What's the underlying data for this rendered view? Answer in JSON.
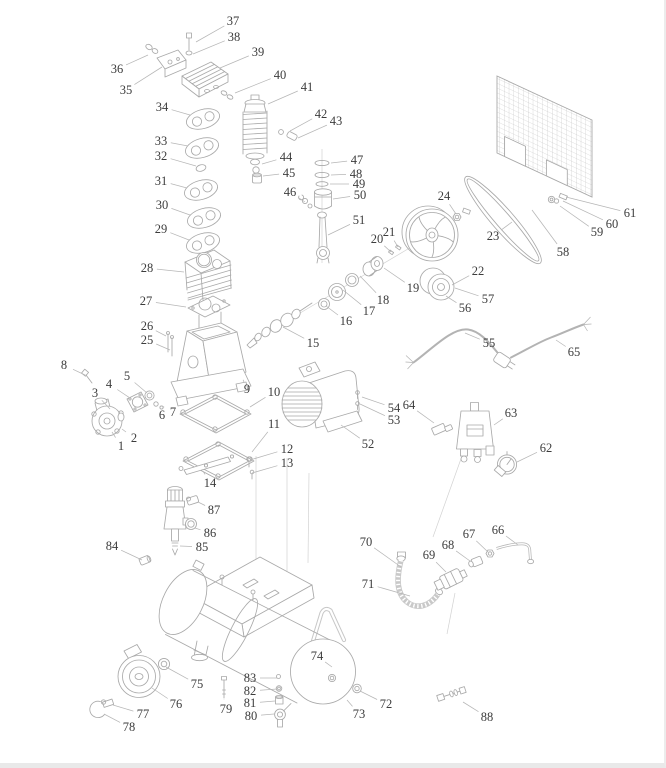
{
  "diagram": {
    "type": "exploded-parts-diagram",
    "colors": {
      "label_ink": "#3c3c3c",
      "leader_line": "#b6b6b6",
      "art_line": "#a9a9a9",
      "background": "#ffffff"
    },
    "parts": [
      {
        "n": "1",
        "x": 121,
        "y": 446,
        "tx": 112,
        "ty": 432
      },
      {
        "n": "2",
        "x": 134,
        "y": 438,
        "tx": 122,
        "ty": 429
      },
      {
        "n": "3",
        "x": 95,
        "y": 393,
        "tx": 110,
        "ty": 409
      },
      {
        "n": "4",
        "x": 109,
        "y": 384,
        "tx": 130,
        "ty": 398
      },
      {
        "n": "5",
        "x": 127,
        "y": 376,
        "tx": 147,
        "ty": 393
      },
      {
        "n": "6",
        "x": 162,
        "y": 415,
        "tx": 156,
        "ty": 407
      },
      {
        "n": "7",
        "x": 173,
        "y": 412,
        "tx": 162,
        "ty": 406
      },
      {
        "n": "8",
        "x": 64,
        "y": 365,
        "tx": 85,
        "ty": 375
      },
      {
        "n": "9",
        "x": 247,
        "y": 389,
        "tx": 244,
        "ty": 382,
        "s": 10
      },
      {
        "n": "10",
        "x": 274,
        "y": 392,
        "tx": 250,
        "ty": 407
      },
      {
        "n": "11",
        "x": 274,
        "y": 424,
        "tx": 252,
        "ty": 452
      },
      {
        "n": "12",
        "x": 287,
        "y": 449,
        "tx": 250,
        "ty": 460
      },
      {
        "n": "13",
        "x": 287,
        "y": 463,
        "tx": 252,
        "ty": 473
      },
      {
        "n": "14",
        "x": 210,
        "y": 483,
        "tx": 203,
        "ty": 471
      },
      {
        "n": "15",
        "x": 313,
        "y": 343,
        "tx": 283,
        "ty": 327
      },
      {
        "n": "16",
        "x": 346,
        "y": 321,
        "tx": 326,
        "ty": 306
      },
      {
        "n": "17",
        "x": 369,
        "y": 311,
        "tx": 343,
        "ty": 290
      },
      {
        "n": "18",
        "x": 383,
        "y": 300,
        "tx": 360,
        "ty": 276
      },
      {
        "n": "19",
        "x": 413,
        "y": 288,
        "tx": 384,
        "ty": 268
      },
      {
        "n": "20",
        "x": 377,
        "y": 239,
        "tx": 391,
        "ty": 252
      },
      {
        "n": "21",
        "x": 389,
        "y": 232,
        "tx": 398,
        "ty": 247
      },
      {
        "n": "22",
        "x": 478,
        "y": 271,
        "tx": 452,
        "ty": 285
      },
      {
        "n": "23",
        "x": 493,
        "y": 236,
        "tx": 512,
        "ty": 222
      },
      {
        "n": "24",
        "x": 444,
        "y": 196,
        "tx": 456,
        "ty": 214
      },
      {
        "n": "25",
        "x": 147,
        "y": 340,
        "tx": 170,
        "ty": 350
      },
      {
        "n": "26",
        "x": 147,
        "y": 326,
        "tx": 166,
        "ty": 336
      },
      {
        "n": "27",
        "x": 146,
        "y": 301,
        "tx": 186,
        "ty": 307
      },
      {
        "n": "28",
        "x": 147,
        "y": 268,
        "tx": 184,
        "ty": 272
      },
      {
        "n": "29",
        "x": 161,
        "y": 229,
        "tx": 189,
        "ty": 240
      },
      {
        "n": "30",
        "x": 162,
        "y": 205,
        "tx": 190,
        "ty": 215
      },
      {
        "n": "31",
        "x": 161,
        "y": 181,
        "tx": 187,
        "ty": 188
      },
      {
        "n": "32",
        "x": 161,
        "y": 156,
        "tx": 196,
        "ty": 166
      },
      {
        "n": "33",
        "x": 161,
        "y": 141,
        "tx": 188,
        "ty": 146
      },
      {
        "n": "34",
        "x": 162,
        "y": 107,
        "tx": 190,
        "ty": 115
      },
      {
        "n": "35",
        "x": 126,
        "y": 90,
        "tx": 162,
        "ty": 67
      },
      {
        "n": "36",
        "x": 117,
        "y": 69,
        "tx": 148,
        "ty": 55
      },
      {
        "n": "37",
        "x": 233,
        "y": 21,
        "tx": 196,
        "ty": 42
      },
      {
        "n": "38",
        "x": 234,
        "y": 37,
        "tx": 193,
        "ty": 54
      },
      {
        "n": "39",
        "x": 258,
        "y": 52,
        "tx": 220,
        "ty": 68
      },
      {
        "n": "40",
        "x": 280,
        "y": 75,
        "tx": 235,
        "ty": 93
      },
      {
        "n": "41",
        "x": 307,
        "y": 87,
        "tx": 268,
        "ty": 104
      },
      {
        "n": "42",
        "x": 321,
        "y": 114,
        "tx": 290,
        "ty": 131
      },
      {
        "n": "43",
        "x": 336,
        "y": 121,
        "tx": 298,
        "ty": 138
      },
      {
        "n": "44",
        "x": 286,
        "y": 157,
        "tx": 262,
        "ty": 164
      },
      {
        "n": "45",
        "x": 289,
        "y": 173,
        "tx": 263,
        "ty": 176
      },
      {
        "n": "46",
        "x": 290,
        "y": 192,
        "tx": 305,
        "ty": 202
      },
      {
        "n": "47",
        "x": 357,
        "y": 160,
        "tx": 331,
        "ty": 163
      },
      {
        "n": "48",
        "x": 356,
        "y": 174,
        "tx": 331,
        "ty": 175
      },
      {
        "n": "49",
        "x": 359,
        "y": 184,
        "tx": 330,
        "ty": 184
      },
      {
        "n": "50",
        "x": 360,
        "y": 195,
        "tx": 333,
        "ty": 199
      },
      {
        "n": "51",
        "x": 359,
        "y": 220,
        "tx": 328,
        "ty": 235
      },
      {
        "n": "52",
        "x": 368,
        "y": 444,
        "tx": 341,
        "ty": 425
      },
      {
        "n": "53",
        "x": 394,
        "y": 420,
        "tx": 360,
        "ty": 404
      },
      {
        "n": "54",
        "x": 394,
        "y": 408,
        "tx": 362,
        "ty": 397
      },
      {
        "n": "55",
        "x": 489,
        "y": 343,
        "tx": 465,
        "ty": 333
      },
      {
        "n": "56",
        "x": 465,
        "y": 308,
        "tx": 446,
        "ty": 296
      },
      {
        "n": "57",
        "x": 488,
        "y": 299,
        "tx": 455,
        "ty": 288
      },
      {
        "n": "58",
        "x": 563,
        "y": 252,
        "tx": 532,
        "ty": 210
      },
      {
        "n": "59",
        "x": 597,
        "y": 232,
        "tx": 560,
        "ty": 206
      },
      {
        "n": "60",
        "x": 612,
        "y": 224,
        "tx": 563,
        "ty": 201
      },
      {
        "n": "61",
        "x": 630,
        "y": 213,
        "tx": 566,
        "ty": 197
      },
      {
        "n": "62",
        "x": 546,
        "y": 448,
        "tx": 517,
        "ty": 462
      },
      {
        "n": "63",
        "x": 511,
        "y": 413,
        "tx": 494,
        "ty": 425
      },
      {
        "n": "64",
        "x": 409,
        "y": 405,
        "tx": 434,
        "ty": 423
      },
      {
        "n": "65",
        "x": 574,
        "y": 352,
        "tx": 556,
        "ty": 340
      },
      {
        "n": "66",
        "x": 498,
        "y": 530,
        "tx": 518,
        "ty": 545
      },
      {
        "n": "67",
        "x": 469,
        "y": 534,
        "tx": 488,
        "ty": 552
      },
      {
        "n": "68",
        "x": 448,
        "y": 545,
        "tx": 470,
        "ty": 561
      },
      {
        "n": "69",
        "x": 429,
        "y": 555,
        "tx": 446,
        "ty": 572
      },
      {
        "n": "70",
        "x": 366,
        "y": 542,
        "tx": 401,
        "ty": 567
      },
      {
        "n": "71",
        "x": 368,
        "y": 584,
        "tx": 410,
        "ty": 596
      },
      {
        "n": "72",
        "x": 386,
        "y": 704,
        "tx": 360,
        "ty": 691
      },
      {
        "n": "73",
        "x": 359,
        "y": 714,
        "tx": 347,
        "ty": 700
      },
      {
        "n": "74",
        "x": 317,
        "y": 656,
        "tx": 332,
        "ty": 667
      },
      {
        "n": "75",
        "x": 197,
        "y": 684,
        "tx": 166,
        "ty": 667
      },
      {
        "n": "76",
        "x": 176,
        "y": 704,
        "tx": 152,
        "ty": 688
      },
      {
        "n": "77",
        "x": 143,
        "y": 714,
        "tx": 113,
        "ty": 705
      },
      {
        "n": "78",
        "x": 129,
        "y": 727,
        "tx": 104,
        "ty": 714
      },
      {
        "n": "79",
        "x": 226,
        "y": 709,
        "tx": 224,
        "ty": 699
      },
      {
        "n": "80",
        "x": 251,
        "y": 716,
        "tx": 274,
        "ty": 714
      },
      {
        "n": "81",
        "x": 250,
        "y": 703,
        "tx": 275,
        "ty": 701
      },
      {
        "n": "82",
        "x": 250,
        "y": 691,
        "tx": 277,
        "ty": 689
      },
      {
        "n": "83",
        "x": 250,
        "y": 678,
        "tx": 277,
        "ty": 678
      },
      {
        "n": "84",
        "x": 112,
        "y": 546,
        "tx": 142,
        "ty": 560
      },
      {
        "n": "85",
        "x": 202,
        "y": 547,
        "tx": 180,
        "ty": 546
      },
      {
        "n": "86",
        "x": 210,
        "y": 533,
        "tx": 195,
        "ty": 528
      },
      {
        "n": "87",
        "x": 214,
        "y": 510,
        "tx": 198,
        "ty": 502
      },
      {
        "n": "88",
        "x": 487,
        "y": 717,
        "tx": 463,
        "ty": 702
      }
    ]
  }
}
